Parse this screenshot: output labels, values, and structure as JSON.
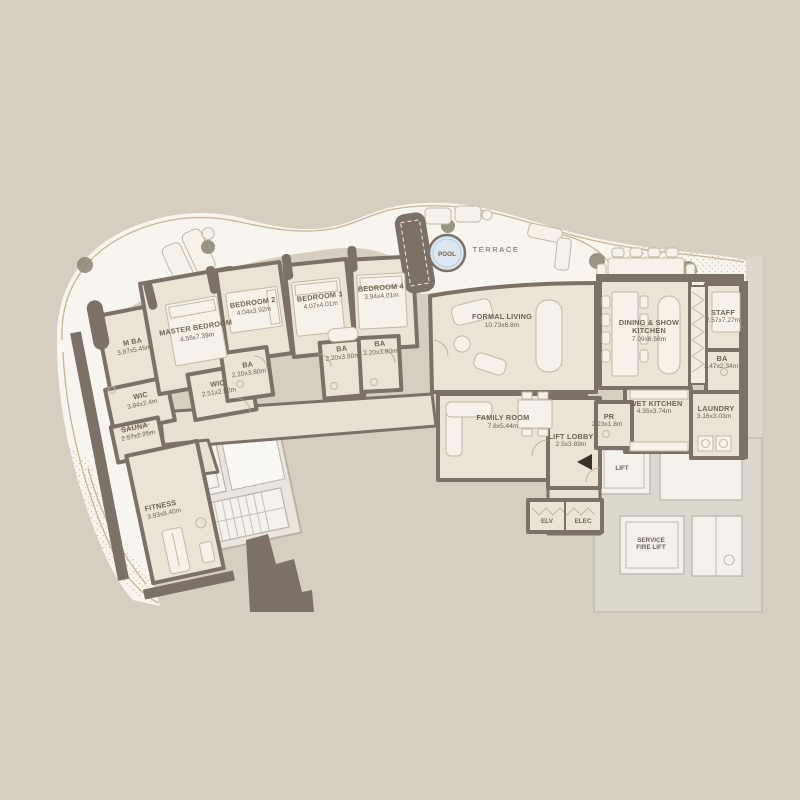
{
  "plan_title": "penthouse-floor-plan",
  "outdoor": {
    "terrace_label": "TERRACE",
    "pool_label": "POOL"
  },
  "rooms": {
    "master_bedroom": {
      "name": "MASTER BEDROOM",
      "dims": "4.58x7.39m"
    },
    "bedroom2": {
      "name": "BEDROOM 2",
      "dims": "4.04x3.92m"
    },
    "bedroom3": {
      "name": "BEDROOM 3",
      "dims": "4.07x4.01m"
    },
    "bedroom4": {
      "name": "BEDROOM 4",
      "dims": "3.94x4.01m"
    },
    "m_ba": {
      "name": "M BA",
      "dims": "3.87x5.45m"
    },
    "wic_master": {
      "name": "WIC",
      "dims": "2.51x2.82m"
    },
    "wic_left": {
      "name": "WIC",
      "dims": "3.84x2.4m"
    },
    "ba_bed2": {
      "name": "BA",
      "dims": "2.20x3.80m"
    },
    "ba_bed3": {
      "name": "BA",
      "dims": "2.20x3.80m"
    },
    "ba_bed4": {
      "name": "BA",
      "dims": "2.20x3.80m"
    },
    "sauna": {
      "name": "SAUNA",
      "dims": "2.57x2.25m"
    },
    "fitness": {
      "name": "FITNESS",
      "dims": "3.93x8.40m"
    },
    "formal_living": {
      "name": "FORMAL LIVING",
      "dims": "10.73x6.8m"
    },
    "family_room": {
      "name": "FAMILY ROOM",
      "dims": "7.8x5.44m"
    },
    "dining": {
      "line1": "DINING & SHOW",
      "line2": "KITCHEN",
      "dims": "7.09x6.56m"
    },
    "staff": {
      "name": "STAFF",
      "dims": "2.57x7.27m"
    },
    "ba_staff": {
      "name": "BA",
      "dims": "1.47x2.34m"
    },
    "wet_kitchen": {
      "name": "WET KITCHEN",
      "dims": "4.35x3.74m"
    },
    "laundry": {
      "name": "LAUNDRY",
      "dims": "3.16x3.03m"
    },
    "pr": {
      "name": "PR",
      "dims": "2.23x1.8m"
    },
    "lift_lobby": {
      "name": "LIFT LOBBY",
      "dims": "2.5x3.89m"
    },
    "lift": {
      "name": "LIFT"
    },
    "service_fire_lift": {
      "line1": "SERVICE",
      "line2": "FIRE LIFT"
    },
    "elv": {
      "name": "ELV"
    },
    "elec": {
      "name": "ELEC"
    }
  },
  "colors": {
    "background": "#d6cfc1",
    "terrace": "#f8f5ef",
    "room_floor": "#eae3d6",
    "wall": "#7c7166",
    "pool_water": "#d9e7f1",
    "core_gray": "#ddd8cd",
    "label_text": "#6f6355"
  }
}
